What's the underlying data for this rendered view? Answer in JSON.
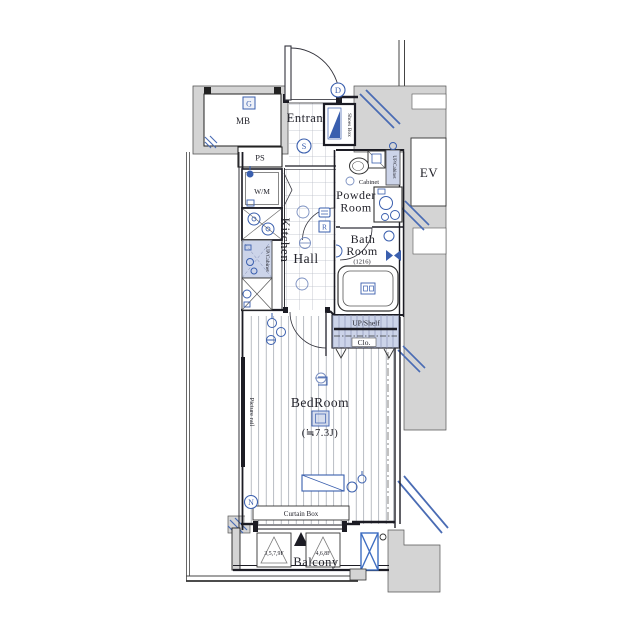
{
  "plan": {
    "labels": {
      "mb": "MB",
      "ps": "PS",
      "entrance": "Entrance",
      "shoes_box": "Shoes Box",
      "wm": "W/M",
      "kitchen": "Kitchen",
      "up_cabinet_kitchen": "UP/Cabinet",
      "hall": "Hall",
      "powder_line1": "Powder",
      "powder_line2": "Room",
      "cabinet": "Cabinet",
      "up_cabinet_powder": "UP/Cabinet",
      "bath_line1": "Bath",
      "bath_line2": "Room",
      "bath_size": "(1216)",
      "ev": "EV",
      "up_shelf": "UP/Shelf",
      "closet": "Clo.",
      "bedroom": "BedRoom",
      "bedroom_size": "(≒7.3J)",
      "picture_rail": "Picture rail",
      "curtain_box": "Curtain Box",
      "balcony": "Balcony",
      "floors_odd": "3,5,7,9F",
      "floors_even": "4,6,8F"
    },
    "markers": {
      "g": "G",
      "d": "D",
      "s": "S",
      "r": "R",
      "n": "N"
    },
    "colors": {
      "accent_blue": "#3a5fae",
      "light_blue_fill": "#ccd4e9",
      "wall_gray": "#d4d4d4",
      "line_dark": "#1c1c24"
    }
  }
}
